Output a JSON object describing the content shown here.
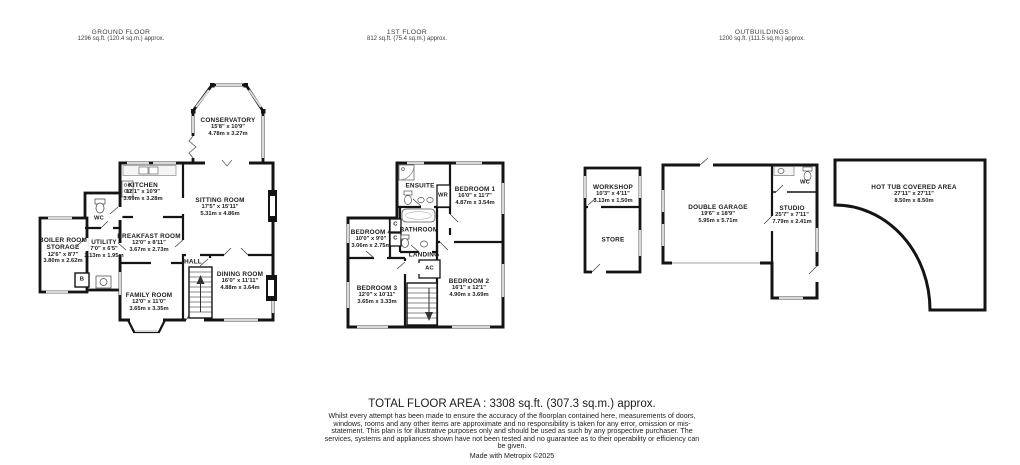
{
  "headers": {
    "ground": {
      "title": "GROUND FLOOR",
      "area": "1296 sq.ft. (120.4 sq.m.) approx."
    },
    "first": {
      "title": "1ST FLOOR",
      "area": "812 sq.ft. (75.4 sq.m.) approx."
    },
    "outbuildings": {
      "title": "OUTBUILDINGS",
      "area": "1200 sq.ft. (111.5 sq.m.) approx."
    }
  },
  "rooms": {
    "conservatory": {
      "name": "CONSERVATORY",
      "imperial": "15'8\" x 10'9\"",
      "metric": "4.78m x 3.27m"
    },
    "kitchen": {
      "name": "KITCHEN",
      "imperial": "12'1\" x 10'9\"",
      "metric": "3.69m x 3.28m"
    },
    "sitting_room": {
      "name": "SITTING ROOM",
      "imperial": "17'5\" x 15'11\"",
      "metric": "5.31m x 4.86m"
    },
    "breakfast_room": {
      "name": "BREAKFAST ROOM",
      "imperial": "12'0\" x 8'11\"",
      "metric": "3.67m x 2.73m"
    },
    "wc_ground": {
      "name": "WC"
    },
    "utility": {
      "name": "UTILITY",
      "imperial": "7'0\" x 6'5\"",
      "metric": "2.13m x 1.95m"
    },
    "boiler_room": {
      "name": "BOILER ROOM",
      "name2": "STORAGE",
      "imperial": "12'6\" x 8'7\"",
      "metric": "3.80m x 2.62m"
    },
    "boiler_b": {
      "name": "B"
    },
    "hall": {
      "name": "HALL"
    },
    "dining_room": {
      "name": "DINING ROOM",
      "imperial": "16'0\" x 11'11\"",
      "metric": "4.88m x 3.64m"
    },
    "family_room": {
      "name": "FAMILY ROOM",
      "imperial": "12'0\" x 11'0\"",
      "metric": "3.65m x 3.35m"
    },
    "ensuite": {
      "name": "ENSUITE"
    },
    "wr": {
      "name": "WR"
    },
    "bedroom1": {
      "name": "BEDROOM 1",
      "imperial": "16'0\" x 11'7\"",
      "metric": "4.87m x 3.54m"
    },
    "bathroom": {
      "name": "BATHROOM"
    },
    "bedroom4": {
      "name": "BEDROOM 4",
      "imperial": "10'0\" x 9'0\"",
      "metric": "3.06m x 2.75m"
    },
    "cupboard": {
      "name": "C"
    },
    "landing": {
      "name": "LANDING"
    },
    "ac": {
      "name": "AC"
    },
    "bedroom3": {
      "name": "BEDROOM 3",
      "imperial": "12'0\" x 10'11\"",
      "metric": "3.65m x 3.33m"
    },
    "bedroom2": {
      "name": "BEDROOM 2",
      "imperial": "16'1\" x 12'1\"",
      "metric": "4.90m x 3.69m"
    },
    "workshop": {
      "name": "WORKSHOP",
      "imperial": "10'3\" x 4'11\"",
      "metric": "3.13m x 1.50m"
    },
    "store": {
      "name": "STORE"
    },
    "double_garage": {
      "name": "DOUBLE GARAGE",
      "imperial": "19'6\" x 18'9\"",
      "metric": "5.95m x 5.71m"
    },
    "studio": {
      "name": "STUDIO",
      "imperial": "25'7\" x 7'11\"",
      "metric": "7.79m x 2.41m"
    },
    "wc_studio": {
      "name": "WC"
    },
    "hot_tub": {
      "name": "HOT TUB COVERED AREA",
      "imperial": "27'11\" x 27'11\"",
      "metric": "8.50m x 8.50m"
    }
  },
  "footer": {
    "total": "TOTAL FLOOR AREA : 3308 sq.ft. (307.3 sq.m.) approx.",
    "disclaimer": "Whilst every attempt has been made to ensure the accuracy of the floorplan contained here, measurements of doors, windows, rooms and any other items are approximate and no responsibility is taken for any error, omission or mis-statement. This plan is for illustrative purposes only and should be used as such by any prospective purchaser. The services, systems and appliances shown have not been tested and no guarantee as to their operability or efficiency can be given.",
    "credit": "Made with Metropix ©2025"
  },
  "colors": {
    "wall": "#141414",
    "window": "#d9d9d9",
    "floor": "#ffffff",
    "text": "#1c1c1c"
  }
}
